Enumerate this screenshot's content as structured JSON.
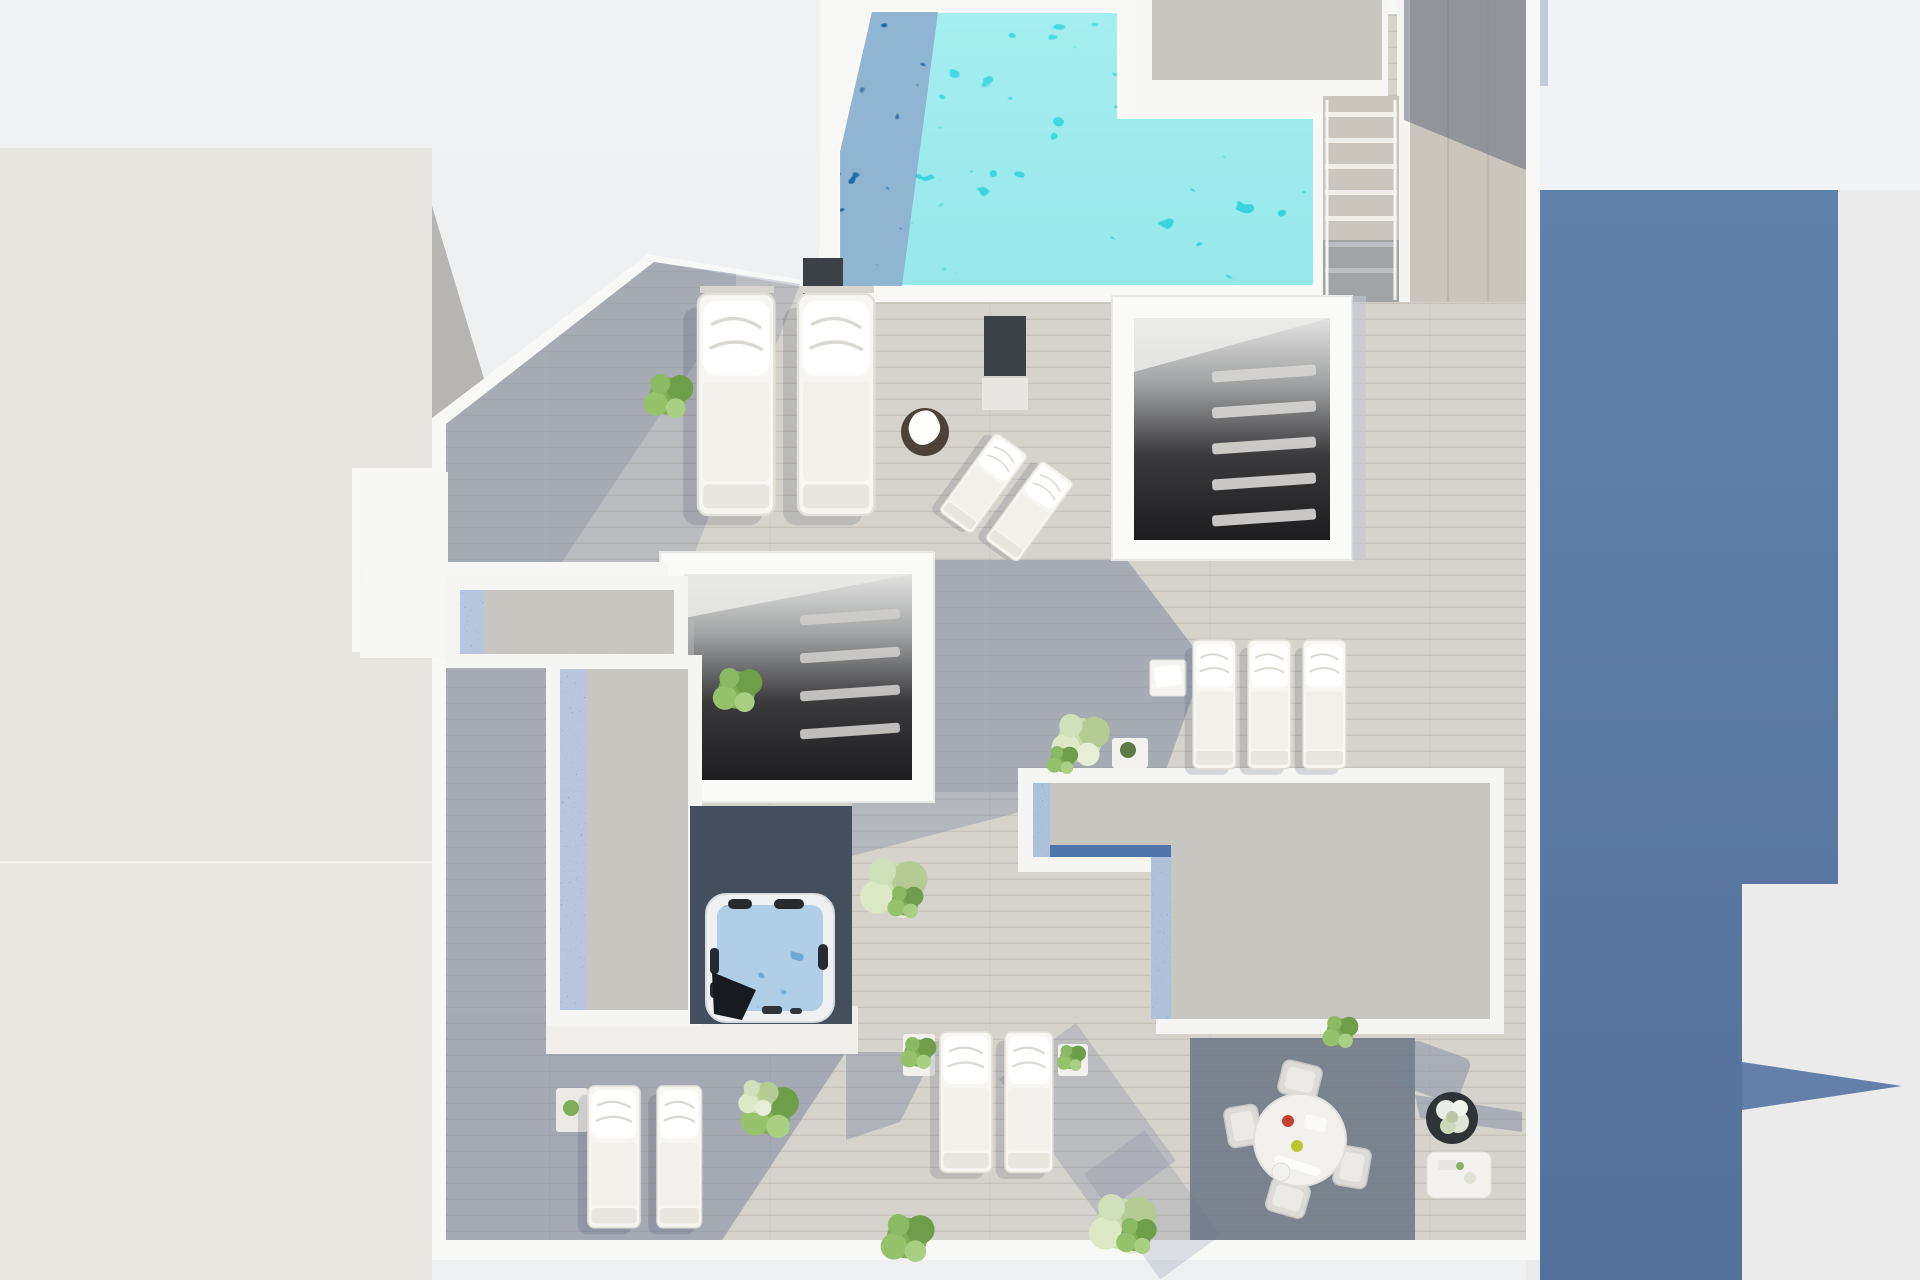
{
  "scene": {
    "description": "Photorealistic top-down 3D architectural rendering of a penthouse rooftop terrace with an L-shaped swimming pool, wooden deck, skylight stairwells, gravel beds, jacuzzi, sun loungers and outdoor dining set",
    "view": "aerial top-down",
    "visible_text": "none"
  },
  "colors": {
    "bg": "#eef0f2",
    "bg_top": "#f0f1f3",
    "neighbor_left": "#e7e5e0",
    "neighbor_left_lower": "#eae8e3",
    "neighbor_shadow": "#b7b5b1",
    "bg_right": "#ebebeb",
    "bg_right_top": "#f2f3f5",
    "building_shadow_blue": "#6181ad",
    "building_shadow_blue2": "#54719b",
    "terrace_white": "#f8f8f7",
    "deck_light": "#d6d3cd",
    "deck_shade": "#76839b",
    "deck_dark": "#454e5c",
    "pool_turquoise": "#2fd2d8",
    "pool_turquoise_light": "#49dce1",
    "pool_deep": "#1d61a0",
    "stair_wood": "#cac5bd",
    "gravel_base": "#dedcd5",
    "gravel_blue": "#4f74ac",
    "stairwell_top": "#e3e3e2",
    "stairwell_bottom": "#1d1d1f",
    "jacuzzi_water": "#6fa9d2",
    "furniture_white": "#f7f6f2",
    "plant_green": "#7fae57",
    "plant_pale": "#c9dcae",
    "planter_dark": "#2f3437",
    "table_brown": "#4c4238",
    "panel_dark": "#3c4148",
    "dining_shadow": "#6b7484"
  },
  "objects": [
    "swimming-pool",
    "pool-deck",
    "gravel-roof-ne",
    "outdoor-staircase",
    "side-walkway",
    "stairwell-skylight-upper",
    "stairwell-skylight-center",
    "gravel-bed-west",
    "gravel-bed-east",
    "jacuzzi",
    "sun-loungers-upper",
    "sun-loungers-east",
    "sun-loungers-lower-left",
    "sun-loungers-lower-middle",
    "reclined-loungers",
    "dining-set",
    "flower-planter",
    "coffee-table",
    "potted-plants",
    "neighboring-building-left",
    "building-shadow-right"
  ]
}
